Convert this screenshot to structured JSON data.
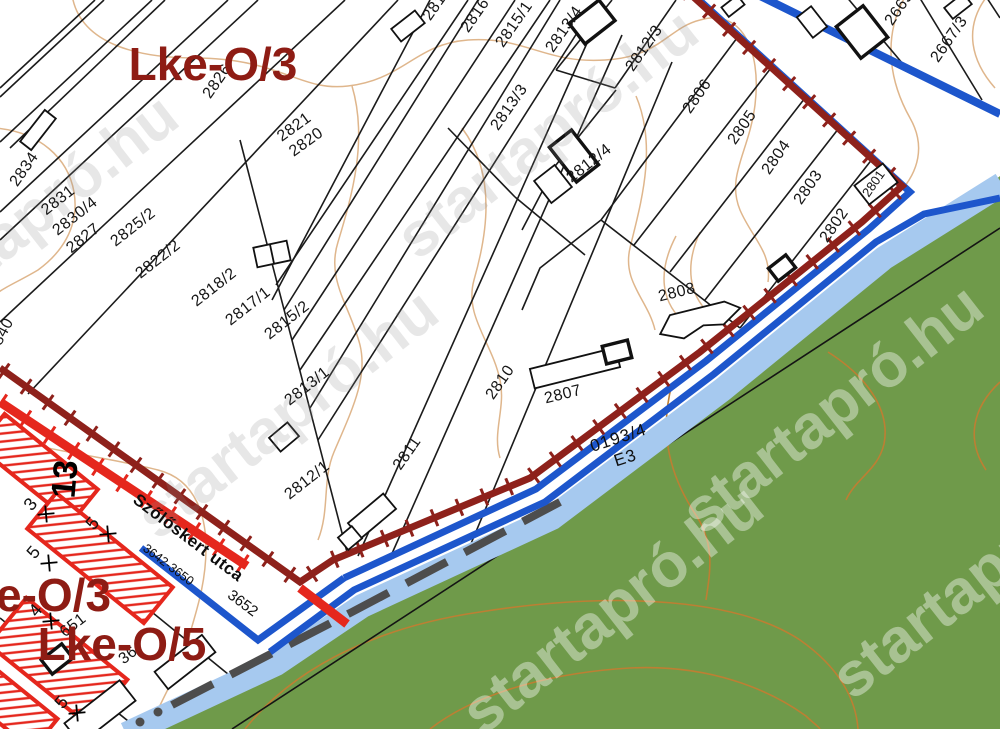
{
  "map": {
    "watermark": "startapró.hu",
    "zones": {
      "top": "Lke-O/3",
      "left_partial": "e-O/3",
      "bottom": "Lke-O/5"
    },
    "street": {
      "name": "Szőlőskert utca",
      "range_label": "3642-3650",
      "number_label": "3652"
    },
    "forest": {
      "parcel": "0193/4",
      "code": "E3"
    },
    "road_label": "13",
    "parcels": [
      "2840",
      "2834",
      "2831",
      "2830/4",
      "2827",
      "2825/2",
      "2826",
      "2821",
      "2820",
      "2822/2",
      "2818/2",
      "2817/1",
      "2815/2",
      "2813/1",
      "2812/1",
      "2811",
      "2810",
      "2807",
      "2808",
      "2806",
      "2805",
      "2804",
      "2803",
      "2802",
      "2801",
      "2817",
      "2816",
      "2815/1",
      "2813/4",
      "2812/3",
      "2813/3",
      "2812/4",
      "2665",
      "2667/3"
    ],
    "fragments": [
      "651",
      "36"
    ],
    "crossed_numbers": [
      "3",
      "5",
      "5",
      "4",
      "5"
    ],
    "colors": {
      "zone_line_dark": "#8e211b",
      "zone_line_red": "#e5271d",
      "water_blue": "#1d56cc",
      "water_light": "#a6c9ef",
      "forest_green": "#6f9a4a",
      "contour_light": "#dfb68c",
      "contour_dark": "#bd7f33",
      "zone_label": "#8e1c14"
    }
  }
}
